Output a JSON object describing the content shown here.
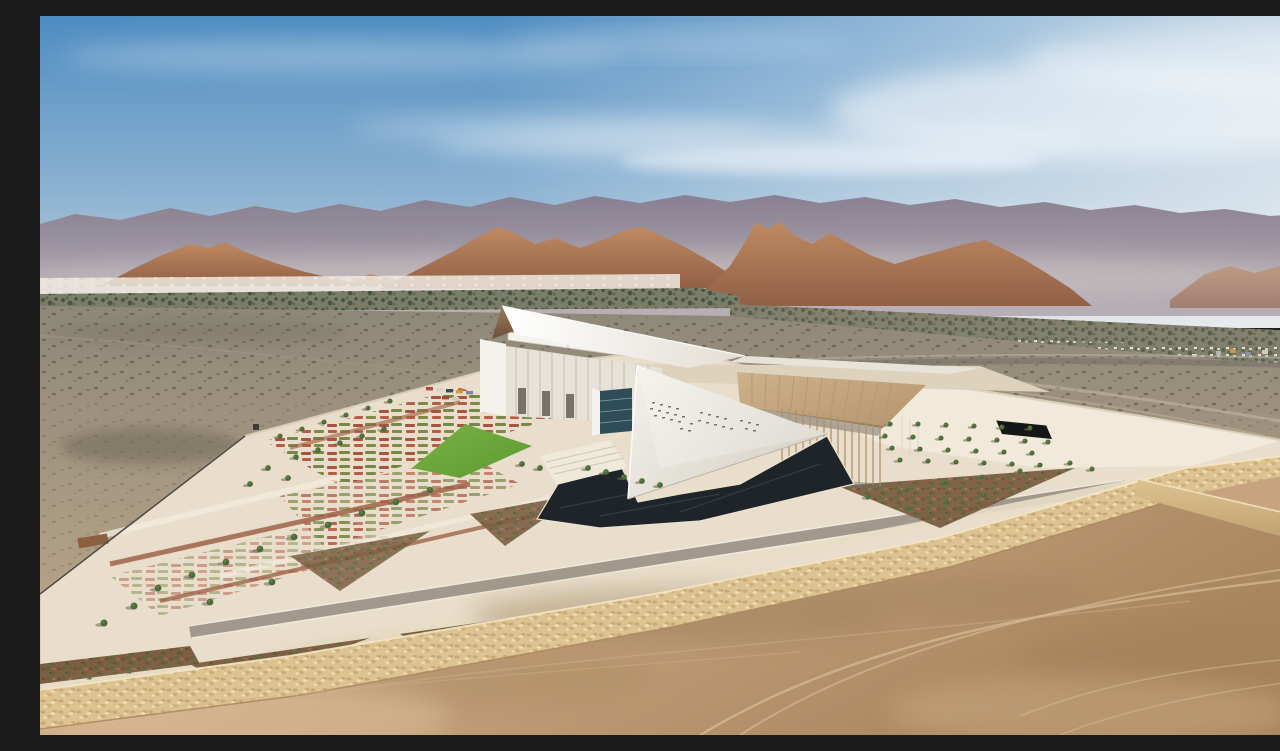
{
  "image": {
    "title": "Aerial photograph of an angular white museum in a desert landscape",
    "description": "Aerial view of a sculptural white museum with a leaning spire and a folded triangular sail facade, fronted by a dark reflecting pool and geometric gardens with lawns, flower beds and young palms. A beige colonnade canopy and tree bosque sit to the right. A long diagonal stone retaining wall separates the landscaped site from graded tan earth with tire tracks in the foreground. Behind, a grey scrub-dotted desert plain runs to a strip of white low buildings and dark palm groves at the foot of red-brown rocky foothills, with a hazy grey-violet mountain range and a blue sky streaked with thin clouds above."
  },
  "scene": {
    "sky": {
      "condition": "clear blue, thin cirrus, brighter haze toward the right"
    },
    "background": {
      "far_mountains": "hazy grey-violet range across the full horizon",
      "foothills": "red-brown rocky foothill clusters",
      "settlement": "low white buildings and dark green date-palm oasis strip"
    },
    "midground": {
      "desert_plain": "grey-brown gravel plain dotted with dark scrub"
    },
    "site": {
      "building": {
        "form": "white angular museum: leaning spire, folded triangular sail, finned rear block, glazed atrium, beige sloped canopy over a slender colonnade",
        "details": [
          "perforated slit windows on the sail",
          "dark sunken entry slot in rear plaza",
          "stepped parapets"
        ]
      },
      "gardens": "triangular flower beds, green lawn, gravel planters with young palms, rows of trees, small parking row",
      "reflecting_pool": "dark angular pool at the foot of the sail",
      "roads": "pale walkways and a grey perimeter road with light curbs",
      "boundary": "long diagonal buff stone retaining wall; thin dark fence on the left"
    },
    "foreground": {
      "ground": "graded tan earth with tire tracks and tonal patches"
    }
  },
  "palette": {
    "sky_top": "#4e8cc1",
    "sky_mid": "#8ab1d1",
    "sky_horizon": "#ccd5d9",
    "cloud_white": "#eef1f2",
    "mountain_far": "#877d8d",
    "mountain_haze": "#b4abb3",
    "hill_light": "#bf8a62",
    "hill_dark": "#915f45",
    "oasis_green": "#41503a",
    "town_white": "#eeeae1",
    "plain_top": "#8e8878",
    "plain_bottom": "#bfa98b",
    "site_paving": "#e8decb",
    "path_light": "#f2ecdd",
    "building_white": "#f4f2ec",
    "building_shade": "#d7d2c8",
    "bronze_light": "#9d7c5d",
    "bronze_dark": "#6d4f39",
    "glass_dark": "#2f4d59",
    "canopy_tan": "#cdb28c",
    "column_tan": "#b2916c",
    "pool_dark": "#1f2428",
    "lawn_light": "#7ab145",
    "lawn_dark": "#5d9a31",
    "tree_green": "#4a6b38",
    "gravel_brown": "#7d5e44",
    "wall_stone": "#dcc391",
    "wall_shadow": "#a8895c",
    "wall_highlight": "#f4e7c3",
    "road_gray": "#a19a8c",
    "dirt_light": "#d8bd97",
    "dirt_mid": "#c5a47e",
    "dirt_dark": "#a7855d",
    "accent_red": "#9a5c41",
    "fence_dark": "#4e4a43",
    "desert_shrub": "#3f3a2f"
  }
}
